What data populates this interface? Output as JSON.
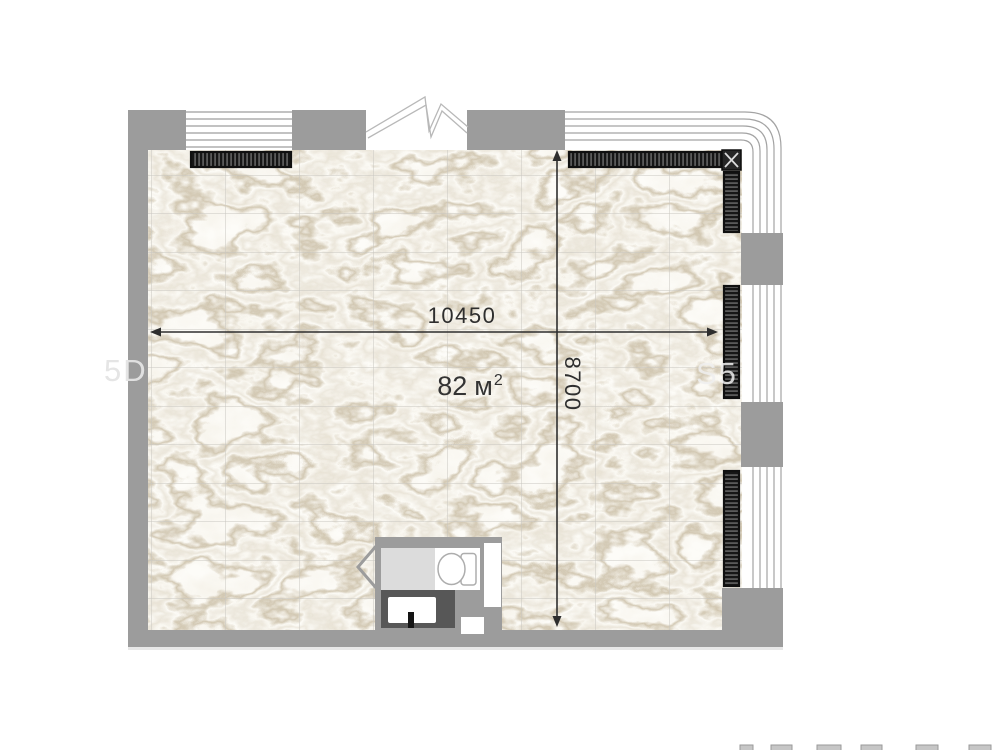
{
  "meta": {
    "type": "apartment-floor-plan"
  },
  "labels": {
    "width_dimension": "10450",
    "height_dimension": "8700",
    "area_value": "82",
    "area_unit": "м",
    "area_superscript": "2"
  },
  "watermarks": {
    "left_fragment": "5D",
    "right_fragment": "S5"
  },
  "colors": {
    "wall": "#9c9c9c",
    "radiator_dark": "#161616",
    "dimension_line": "#2e2e2e",
    "floor_tile_line": "#c8c6c0",
    "marble_vein": "#a28e66",
    "counter": "#575757",
    "shower_tray": "#dcdcdc",
    "fixture_white": "#ffffff"
  },
  "icons": {
    "break-line-icon": "double-zigzag",
    "corner-joint-icon": "boxed-x",
    "toilet-icon": "oval-with-tank",
    "sink-icon": "rounded-rect",
    "faucet-icon": "small-bar",
    "door-swing-icon": "open-chevron",
    "radiator-icon": "hatched-strip",
    "window-icon": "parallel-lines"
  }
}
